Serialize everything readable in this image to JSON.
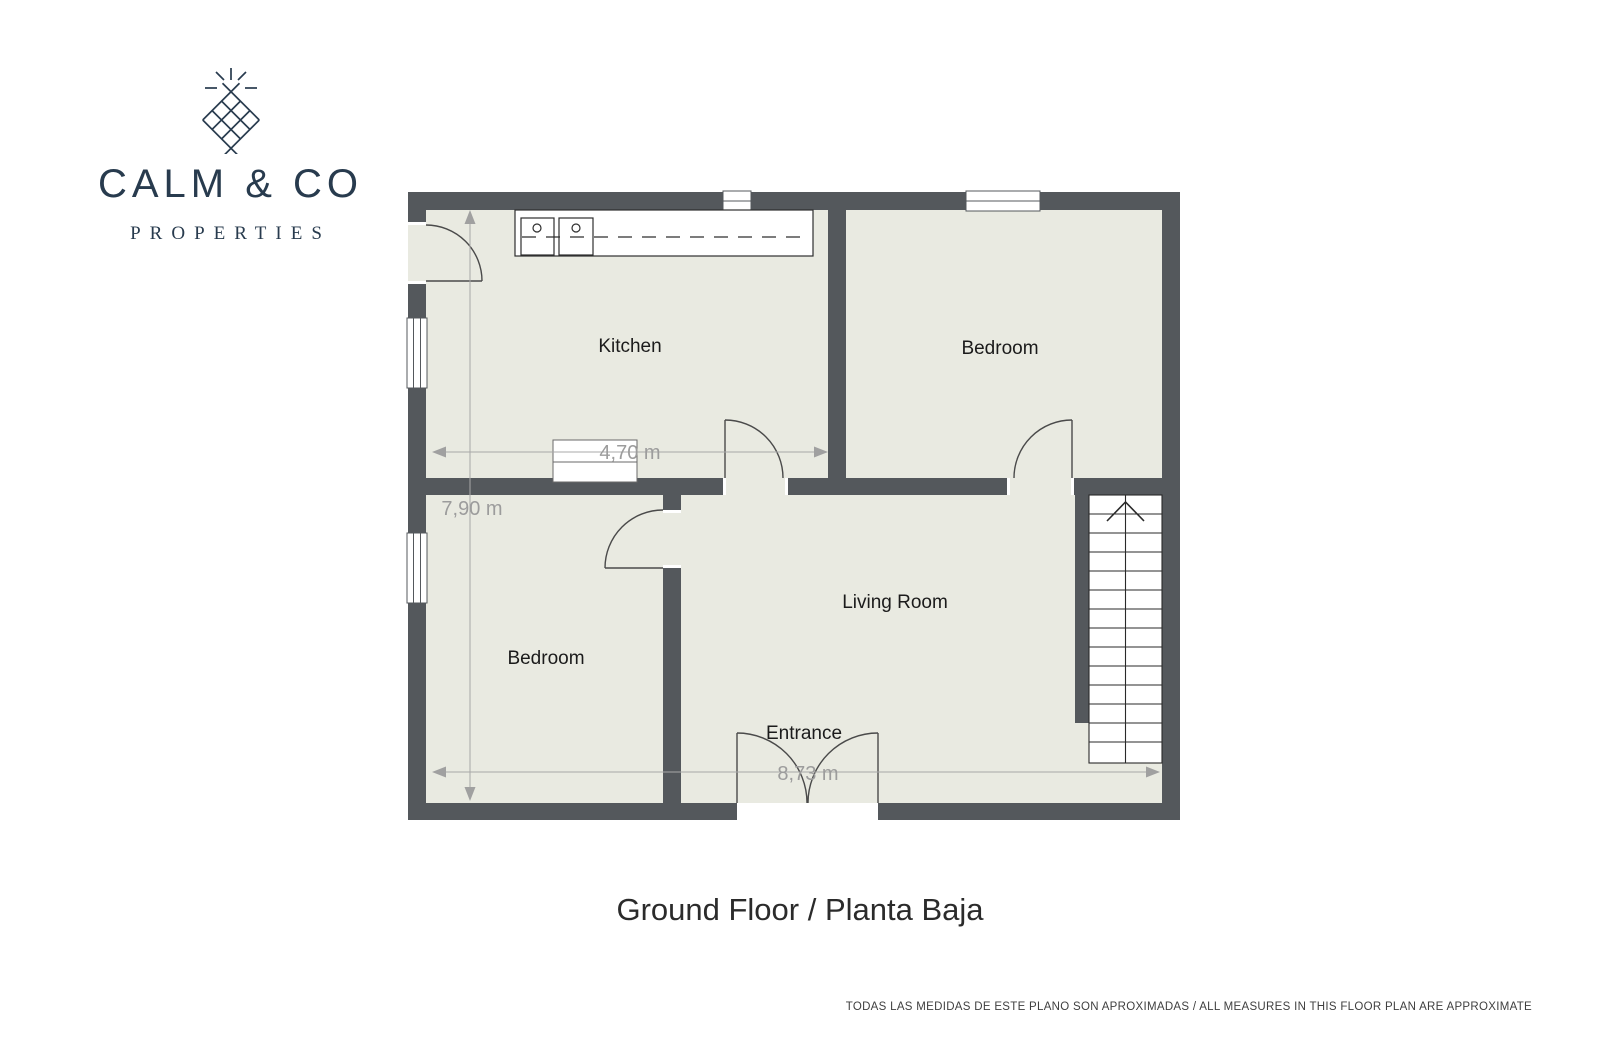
{
  "logo": {
    "brand": "CALM & CO",
    "tagline": "PROPERTIES",
    "icon": "diamond-lattice-sparkle-icon",
    "color": "#283b4e"
  },
  "floor_plan": {
    "rooms": {
      "kitchen": {
        "label": "Kitchen"
      },
      "bedroom_top": {
        "label": "Bedroom"
      },
      "bedroom_bottom": {
        "label": "Bedroom"
      },
      "living_room": {
        "label": "Living Room"
      },
      "entrance": {
        "label": "Entrance"
      }
    },
    "measurements": {
      "kitchen_width": "4,70 m",
      "plan_height": "7,90 m",
      "plan_width": "8,73 m"
    },
    "stairs": {
      "direction": "up"
    },
    "colors": {
      "wall": "#54585c",
      "floor": "#e9eae1",
      "dimension": "#9c9c9c",
      "room_label": "#1b1b1b"
    }
  },
  "title": "Ground Floor / Planta Baja",
  "footer": {
    "disclaimer": "TODAS LAS MEDIDAS DE ESTE PLANO SON APROXIMADAS / ALL MEASURES IN THIS FLOOR PLAN ARE APPROXIMATE"
  }
}
